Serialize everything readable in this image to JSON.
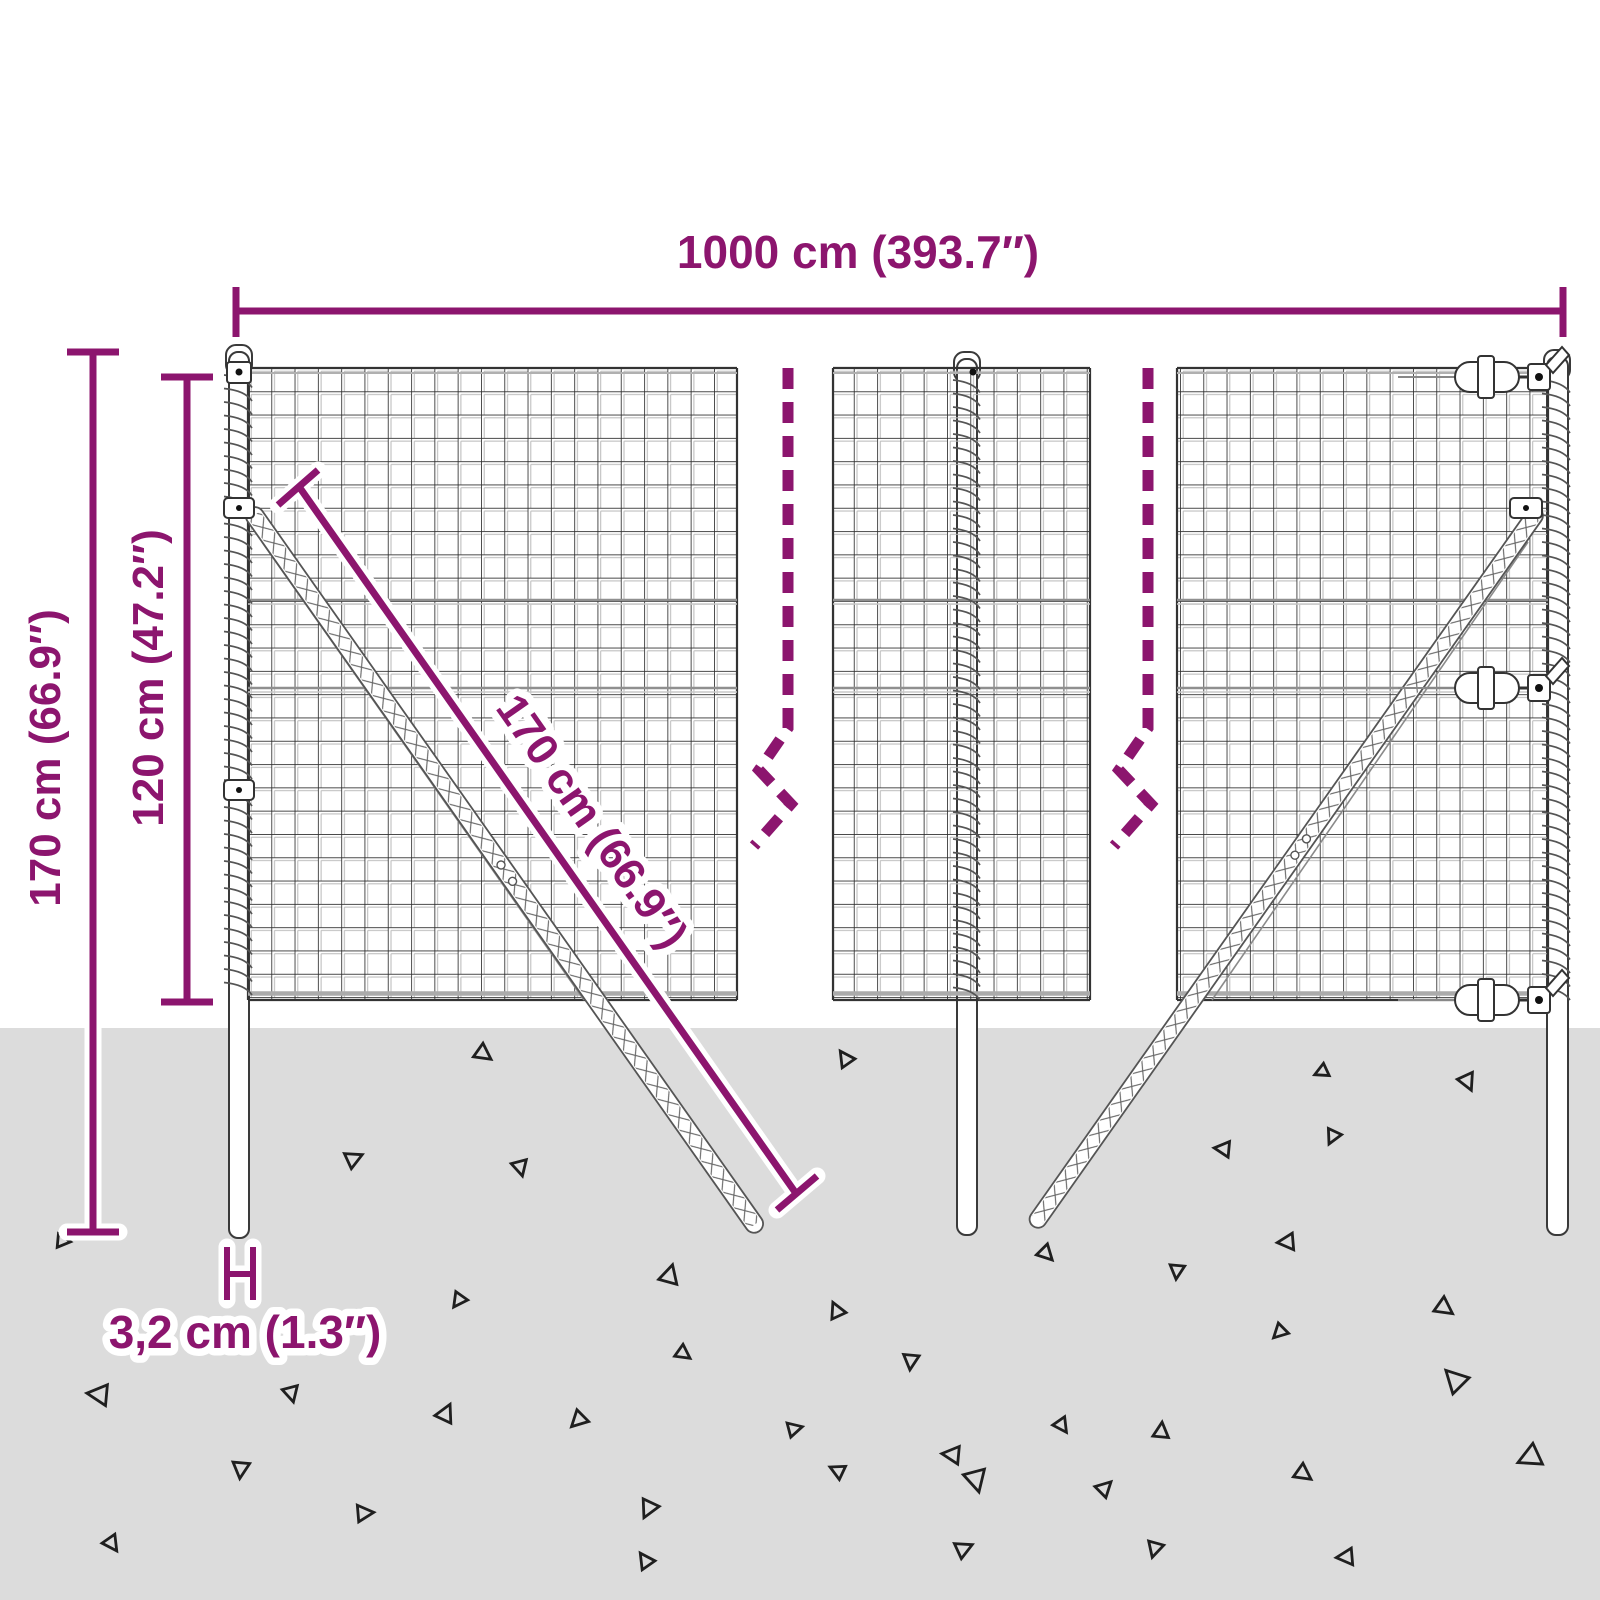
{
  "dimensions": {
    "width": {
      "label": "1000 cm (393.7″)"
    },
    "total_height": {
      "label": "170 cm (66.9″)"
    },
    "mesh_height": {
      "label": "120 cm (47.2″)"
    },
    "diagonal": {
      "label": "170 cm (66.9″)"
    },
    "post_width": {
      "label": "3,2 cm (1.3″)"
    }
  },
  "colors": {
    "accent": "#8C156E",
    "ground": "#DCDCDC",
    "mesh_wire": "#2F2F2F",
    "casing": "#FFFFFF"
  }
}
